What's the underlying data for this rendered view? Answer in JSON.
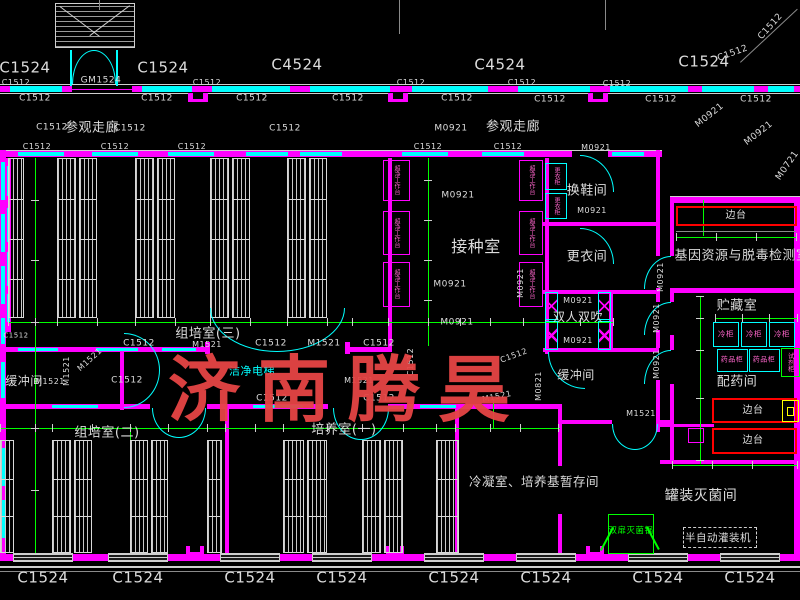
{
  "palette": {
    "background": "#000000",
    "wall_magenta": "#ff00ff",
    "window_cyan": "#00ffff",
    "grid_green": "#00ff00",
    "bench_red": "#ff0000",
    "fixture_pink": "#ff66cc",
    "sink_yellow": "#ffff00",
    "text_white": "#dcdcdc",
    "watermark_red": "#e64545"
  },
  "watermark": {
    "text": "济南腾昊"
  },
  "room_labels": [
    {
      "n": "room-visiting-corridor-left",
      "t": "参观走廊",
      "x": 92,
      "y": 128,
      "s": 13
    },
    {
      "n": "room-visiting-corridor-right",
      "t": "参观走廊",
      "x": 513,
      "y": 127,
      "s": 13
    },
    {
      "n": "room-inoculation",
      "t": "接种室",
      "x": 476,
      "y": 247,
      "s": 16
    },
    {
      "n": "room-shoe-change",
      "t": "换鞋间",
      "x": 587,
      "y": 191,
      "s": 13
    },
    {
      "n": "room-change-clothes",
      "t": "更衣间",
      "x": 587,
      "y": 257,
      "s": 13
    },
    {
      "n": "room-air-shower",
      "t": "双人双吹",
      "x": 578,
      "y": 317,
      "s": 12
    },
    {
      "n": "room-buffer-right",
      "t": "缓冲间",
      "x": 576,
      "y": 375,
      "s": 12
    },
    {
      "n": "room-buffer-left",
      "t": "缓冲间",
      "x": 24,
      "y": 381,
      "s": 12
    },
    {
      "n": "room-tissue-culture-3",
      "t": "组培室(三)",
      "x": 208,
      "y": 334,
      "s": 13
    },
    {
      "n": "room-tissue-culture-2",
      "t": "组培室(二)",
      "x": 107,
      "y": 433,
      "s": 13
    },
    {
      "n": "room-culture-1",
      "t": "培养室(一)",
      "x": 344,
      "y": 430,
      "s": 13
    },
    {
      "n": "room-gene-resource",
      "t": "基因资源与脱毒检测室",
      "x": 742,
      "y": 256,
      "s": 13
    },
    {
      "n": "room-storage",
      "t": "贮藏室",
      "x": 737,
      "y": 306,
      "s": 13
    },
    {
      "n": "room-medicine-prep",
      "t": "配药间",
      "x": 737,
      "y": 382,
      "s": 13
    },
    {
      "n": "room-canning-sterilization",
      "t": "罐装灭菌间",
      "x": 701,
      "y": 496,
      "s": 14
    },
    {
      "n": "room-condense-media",
      "t": "冷凝室、培养基暂存间",
      "x": 534,
      "y": 482,
      "s": 12.5
    },
    {
      "n": "room-clean-elevator",
      "t": "洁净电梯",
      "x": 252,
      "y": 371,
      "s": 11,
      "c": "cyan"
    }
  ],
  "equipment_labels": [
    {
      "n": "equip-semi-auto-filler",
      "t": "半自动灌装机",
      "x": 718,
      "y": 538,
      "s": 10.5
    },
    {
      "n": "equip-double-door-sterilizer",
      "t": "双扉灭菌锅",
      "x": 631,
      "y": 531,
      "s": 8.5,
      "c": "green"
    },
    {
      "n": "equip-side-bench",
      "t": "边台",
      "x": 736,
      "y": 216,
      "s": 10
    },
    {
      "n": "equip-side-bench",
      "t": "边台",
      "x": 753,
      "y": 411,
      "s": 10
    },
    {
      "n": "equip-side-bench",
      "t": "边台",
      "x": 753,
      "y": 441,
      "s": 10
    },
    {
      "n": "equip-freezer",
      "t": "冷柜",
      "x": 726,
      "y": 334,
      "s": 7.5,
      "c": "pink"
    },
    {
      "n": "equip-freezer",
      "t": "冷柜",
      "x": 754,
      "y": 334,
      "s": 7.5,
      "c": "pink"
    },
    {
      "n": "equip-freezer",
      "t": "冷柜",
      "x": 782,
      "y": 334,
      "s": 7.5,
      "c": "pink"
    },
    {
      "n": "equip-medicine-cabinet",
      "t": "药品柜",
      "x": 732,
      "y": 360,
      "s": 7,
      "c": "pink"
    },
    {
      "n": "equip-medicine-cabinet",
      "t": "药品柜",
      "x": 764,
      "y": 360,
      "s": 7,
      "c": "pink"
    },
    {
      "n": "equip-reagent-cabinet",
      "t": "试剂柜",
      "x": 790,
      "y": 362,
      "s": 6.5,
      "c": "pink",
      "v": 1
    },
    {
      "n": "equip-clean-bench",
      "t": "超净工作台",
      "x": 396,
      "y": 180,
      "s": 6,
      "c": "pink",
      "v": 1
    },
    {
      "n": "equip-clean-bench",
      "t": "超净工作台",
      "x": 396,
      "y": 233,
      "s": 6,
      "c": "pink",
      "v": 1
    },
    {
      "n": "equip-clean-bench",
      "t": "超净工作台",
      "x": 396,
      "y": 284,
      "s": 6,
      "c": "pink",
      "v": 1
    },
    {
      "n": "equip-clean-bench",
      "t": "超净工作台",
      "x": 531,
      "y": 180,
      "s": 6,
      "c": "pink",
      "v": 1
    },
    {
      "n": "equip-clean-bench",
      "t": "超净工作台",
      "x": 531,
      "y": 233,
      "s": 6,
      "c": "pink",
      "v": 1
    },
    {
      "n": "equip-clean-bench",
      "t": "超净工作台",
      "x": 531,
      "y": 284,
      "s": 6,
      "c": "pink",
      "v": 1
    },
    {
      "n": "equip-wardrobe",
      "t": "更衣柜",
      "x": 556,
      "y": 176,
      "s": 6,
      "c": "pink",
      "v": 1
    },
    {
      "n": "equip-wardrobe",
      "t": "更衣柜",
      "x": 556,
      "y": 206,
      "s": 6,
      "c": "pink",
      "v": 1
    }
  ],
  "tags": [
    {
      "t": "C1524",
      "x": 25,
      "y": 68,
      "s": 15
    },
    {
      "t": "C1524",
      "x": 163,
      "y": 68,
      "s": 15
    },
    {
      "t": "C4524",
      "x": 297,
      "y": 65,
      "s": 15
    },
    {
      "t": "C4524",
      "x": 500,
      "y": 65,
      "s": 15
    },
    {
      "t": "C1524",
      "x": 704,
      "y": 62,
      "s": 15
    },
    {
      "t": "C1512",
      "x": 733,
      "y": 54,
      "s": 9,
      "r": -20
    },
    {
      "t": "C1512",
      "x": 771,
      "y": 27,
      "s": 9,
      "r": -48
    },
    {
      "t": "GM1524",
      "x": 101,
      "y": 81,
      "s": 9
    },
    {
      "t": "C1512",
      "x": 16,
      "y": 83,
      "s": 8
    },
    {
      "t": "C1512",
      "x": 207,
      "y": 83,
      "s": 8
    },
    {
      "t": "C1512",
      "x": 411,
      "y": 83,
      "s": 8
    },
    {
      "t": "C1512",
      "x": 522,
      "y": 83,
      "s": 8
    },
    {
      "t": "C1512",
      "x": 617,
      "y": 84,
      "s": 8
    },
    {
      "t": "C1512",
      "x": 35,
      "y": 99,
      "s": 9
    },
    {
      "t": "C1512",
      "x": 157,
      "y": 99,
      "s": 9
    },
    {
      "t": "C1512",
      "x": 252,
      "y": 99,
      "s": 9
    },
    {
      "t": "C1512",
      "x": 348,
      "y": 99,
      "s": 9
    },
    {
      "t": "C1512",
      "x": 457,
      "y": 99,
      "s": 9
    },
    {
      "t": "C1512",
      "x": 550,
      "y": 100,
      "s": 9
    },
    {
      "t": "C1512",
      "x": 661,
      "y": 100,
      "s": 9
    },
    {
      "t": "C1512",
      "x": 756,
      "y": 100,
      "s": 9
    },
    {
      "t": "C1512",
      "x": 52,
      "y": 128,
      "s": 9
    },
    {
      "t": "C1512",
      "x": 130,
      "y": 129,
      "s": 9
    },
    {
      "t": "C1512",
      "x": 285,
      "y": 129,
      "s": 9
    },
    {
      "t": "M0921",
      "x": 451,
      "y": 129,
      "s": 9
    },
    {
      "t": "M0921",
      "x": 710,
      "y": 116,
      "s": 9,
      "r": -38
    },
    {
      "t": "M0921",
      "x": 759,
      "y": 134,
      "s": 9,
      "r": -38
    },
    {
      "t": "M0721",
      "x": 788,
      "y": 166,
      "s": 9,
      "r": -55
    },
    {
      "t": "C1512",
      "x": 37,
      "y": 147,
      "s": 8
    },
    {
      "t": "C1512",
      "x": 115,
      "y": 147,
      "s": 8
    },
    {
      "t": "C1512",
      "x": 192,
      "y": 147,
      "s": 8
    },
    {
      "t": "C1512",
      "x": 428,
      "y": 147,
      "s": 8
    },
    {
      "t": "C1512",
      "x": 508,
      "y": 147,
      "s": 8
    },
    {
      "t": "M0921",
      "x": 596,
      "y": 148,
      "s": 8
    },
    {
      "t": "M0921",
      "x": 458,
      "y": 196,
      "s": 9
    },
    {
      "t": "M0921",
      "x": 450,
      "y": 285,
      "s": 9
    },
    {
      "t": "M0921",
      "x": 457,
      "y": 323,
      "s": 9
    },
    {
      "t": "M0921",
      "x": 521,
      "y": 283,
      "s": 8,
      "r": -90
    },
    {
      "t": "M0921",
      "x": 592,
      "y": 211,
      "s": 8
    },
    {
      "t": "M0921",
      "x": 578,
      "y": 301,
      "s": 8
    },
    {
      "t": "M0921",
      "x": 578,
      "y": 341,
      "s": 8
    },
    {
      "t": "M0921",
      "x": 661,
      "y": 277,
      "s": 8,
      "r": -90
    },
    {
      "t": "M0921",
      "x": 657,
      "y": 318,
      "s": 8,
      "r": -90
    },
    {
      "t": "M0921",
      "x": 657,
      "y": 364,
      "s": 8,
      "r": -90
    },
    {
      "t": "M1521",
      "x": 207,
      "y": 345,
      "s": 8
    },
    {
      "t": "M1521",
      "x": 50,
      "y": 382,
      "s": 8
    },
    {
      "t": "M1521",
      "x": 67,
      "y": 371,
      "s": 8,
      "r": -90
    },
    {
      "t": "M1521",
      "x": 90,
      "y": 360,
      "s": 8,
      "r": -42
    },
    {
      "t": "C1512",
      "x": 139,
      "y": 344,
      "s": 9
    },
    {
      "t": "C1512",
      "x": 127,
      "y": 381,
      "s": 9
    },
    {
      "t": "C1512",
      "x": 16,
      "y": 336,
      "s": 7
    },
    {
      "t": "C1512",
      "x": 271,
      "y": 344,
      "s": 9
    },
    {
      "t": "M1521",
      "x": 324,
      "y": 344,
      "s": 9
    },
    {
      "t": "C1512",
      "x": 379,
      "y": 344,
      "s": 9
    },
    {
      "t": "C1512",
      "x": 272,
      "y": 399,
      "s": 9
    },
    {
      "t": "C1512",
      "x": 379,
      "y": 399,
      "s": 9
    },
    {
      "t": "C1512",
      "x": 411,
      "y": 362,
      "s": 8,
      "r": -90
    },
    {
      "t": "M1521",
      "x": 359,
      "y": 381,
      "s": 8
    },
    {
      "t": "C1512",
      "x": 514,
      "y": 356,
      "s": 8,
      "r": -20
    },
    {
      "t": "M1521",
      "x": 497,
      "y": 397,
      "s": 8,
      "r": -12
    },
    {
      "t": "M0821",
      "x": 539,
      "y": 386,
      "s": 8,
      "r": -90
    },
    {
      "t": "M1521",
      "x": 641,
      "y": 414,
      "s": 8
    },
    {
      "t": "C1524",
      "x": 43,
      "y": 578,
      "s": 15
    },
    {
      "t": "C1524",
      "x": 138,
      "y": 578,
      "s": 15
    },
    {
      "t": "C1524",
      "x": 250,
      "y": 578,
      "s": 15
    },
    {
      "t": "C1524",
      "x": 342,
      "y": 578,
      "s": 15
    },
    {
      "t": "C1524",
      "x": 454,
      "y": 578,
      "s": 15
    },
    {
      "t": "C1524",
      "x": 546,
      "y": 578,
      "s": 15
    },
    {
      "t": "C1524",
      "x": 658,
      "y": 578,
      "s": 15
    },
    {
      "t": "C1524",
      "x": 750,
      "y": 578,
      "s": 15
    }
  ]
}
